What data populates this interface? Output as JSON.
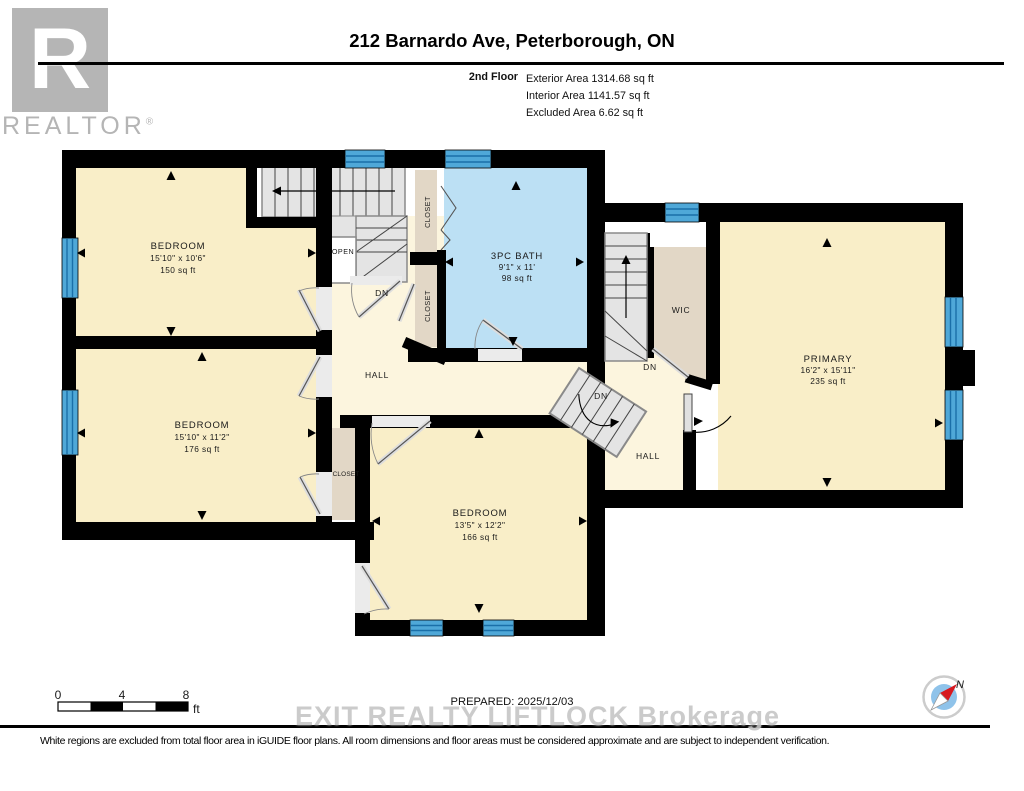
{
  "header": {
    "logo": {
      "letter": "R",
      "brand": "REALTOR",
      "reg": "®"
    },
    "title": "212 Barnardo Ave, Peterborough, ON",
    "floor_label": "2nd Floor",
    "areas": {
      "exterior": "Exterior Area 1314.68 sq ft",
      "interior": "Interior Area 1141.57 sq ft",
      "excluded": "Excluded Area 6.62 sq ft"
    }
  },
  "plan": {
    "labels": {
      "bedroom1": {
        "name": "BEDROOM",
        "dims": "15'10\" x 10'6\"",
        "area": "150 sq ft"
      },
      "bedroom2": {
        "name": "BEDROOM",
        "dims": "15'10\" x 11'2\"",
        "area": "176 sq ft"
      },
      "bedroom3": {
        "name": "BEDROOM",
        "dims": "13'5\" x 12'2\"",
        "area": "166 sq ft"
      },
      "bath": {
        "name": "3PC BATH",
        "dims": "9'1\" x 11'",
        "area": "98 sq ft"
      },
      "primary": {
        "name": "PRIMARY",
        "dims": "16'2\" x 15'11\"",
        "area": "235 sq ft"
      },
      "wic": "WIC",
      "hall_left": "HALL",
      "hall_right": "HALL",
      "closet_top": "CLOSET",
      "closet_mid": "CLOSET",
      "closet_small": "CLOSET",
      "open": "OPEN",
      "dn_left": "DN",
      "dn_upper": "DN",
      "dn_lower": "DN"
    },
    "colors": {
      "room": "#F9EEC8",
      "hall": "#FCF5DE",
      "bath": "#BCE0F4",
      "closet": "#E2D7C6",
      "stairs": "#E4E4E4",
      "window": "#4FA8D8",
      "window_stripe": "#1A6FA8",
      "wall": "#000000"
    }
  },
  "scale_bar": {
    "tick0": "0",
    "tick1": "4",
    "tick2": "8",
    "unit": "ft"
  },
  "compass": {
    "label": "N"
  },
  "footer": {
    "prepared": "PREPARED: 2025/12/03",
    "watermark": "EXIT REALTY LIFTLOCK Brokerage",
    "disclaimer": "White regions are excluded from total floor area in iGUIDE floor plans. All room dimensions and floor areas must be considered approximate and are subject to independent verification."
  }
}
